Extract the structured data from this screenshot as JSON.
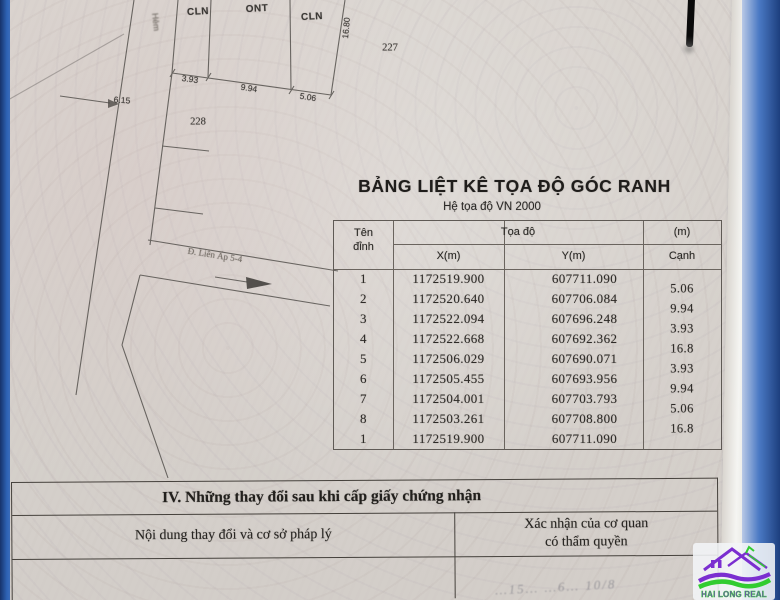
{
  "page": {
    "title": "BẢNG LIỆT KÊ TỌA ĐỘ GÓC RANH",
    "subtitle": "Hệ tọa độ  VN 2000"
  },
  "sketch": {
    "labels": {
      "parcel1": "CLN",
      "parcel2": "ONT",
      "parcel3": "CLN",
      "dim_bottom1": "3.93",
      "dim_bottom2": "9.94",
      "dim_bottom3": "5.06",
      "dim_side": "16.80",
      "lot_right": "227",
      "lot_left": "228",
      "road_width": "6.15",
      "alley": "Hẻm",
      "road": "Đ. Liên Ấp 5-4"
    }
  },
  "table": {
    "header": {
      "ten": "Tên",
      "dinh": "đỉnh",
      "toa_do": "Tọa độ",
      "x": "X(m)",
      "y": "Y(m)",
      "m": "(m)",
      "canh": "Cạnh"
    },
    "rows": [
      {
        "id": "1",
        "x": "1172519.900",
        "y": "607711.090"
      },
      {
        "id": "2",
        "x": "1172520.640",
        "y": "607706.084"
      },
      {
        "id": "3",
        "x": "1172522.094",
        "y": "607696.248"
      },
      {
        "id": "4",
        "x": "1172522.668",
        "y": "607692.362"
      },
      {
        "id": "5",
        "x": "1172506.029",
        "y": "607690.071"
      },
      {
        "id": "6",
        "x": "1172505.455",
        "y": "607693.956"
      },
      {
        "id": "7",
        "x": "1172504.001",
        "y": "607703.793"
      },
      {
        "id": "8",
        "x": "1172503.261",
        "y": "607708.800"
      },
      {
        "id": "1",
        "x": "1172519.900",
        "y": "607711.090"
      }
    ],
    "edges": [
      "5.06",
      "9.94",
      "3.93",
      "16.8",
      "3.93",
      "9.94",
      "5.06",
      "16.8"
    ]
  },
  "section4": {
    "heading": "IV. Những thay đổi sau khi cấp giấy chứng nhận",
    "col_left": "Nội dung thay đổi và cơ sở pháp lý",
    "col_right_line1": "Xác nhận của cơ quan",
    "col_right_line2": "có thẩm quyền",
    "handwriting": "…15… …6… 10/8"
  },
  "logo": {
    "text": "HAI LONG REAL",
    "purple": "#7b2fd0",
    "green": "#32cc30"
  }
}
